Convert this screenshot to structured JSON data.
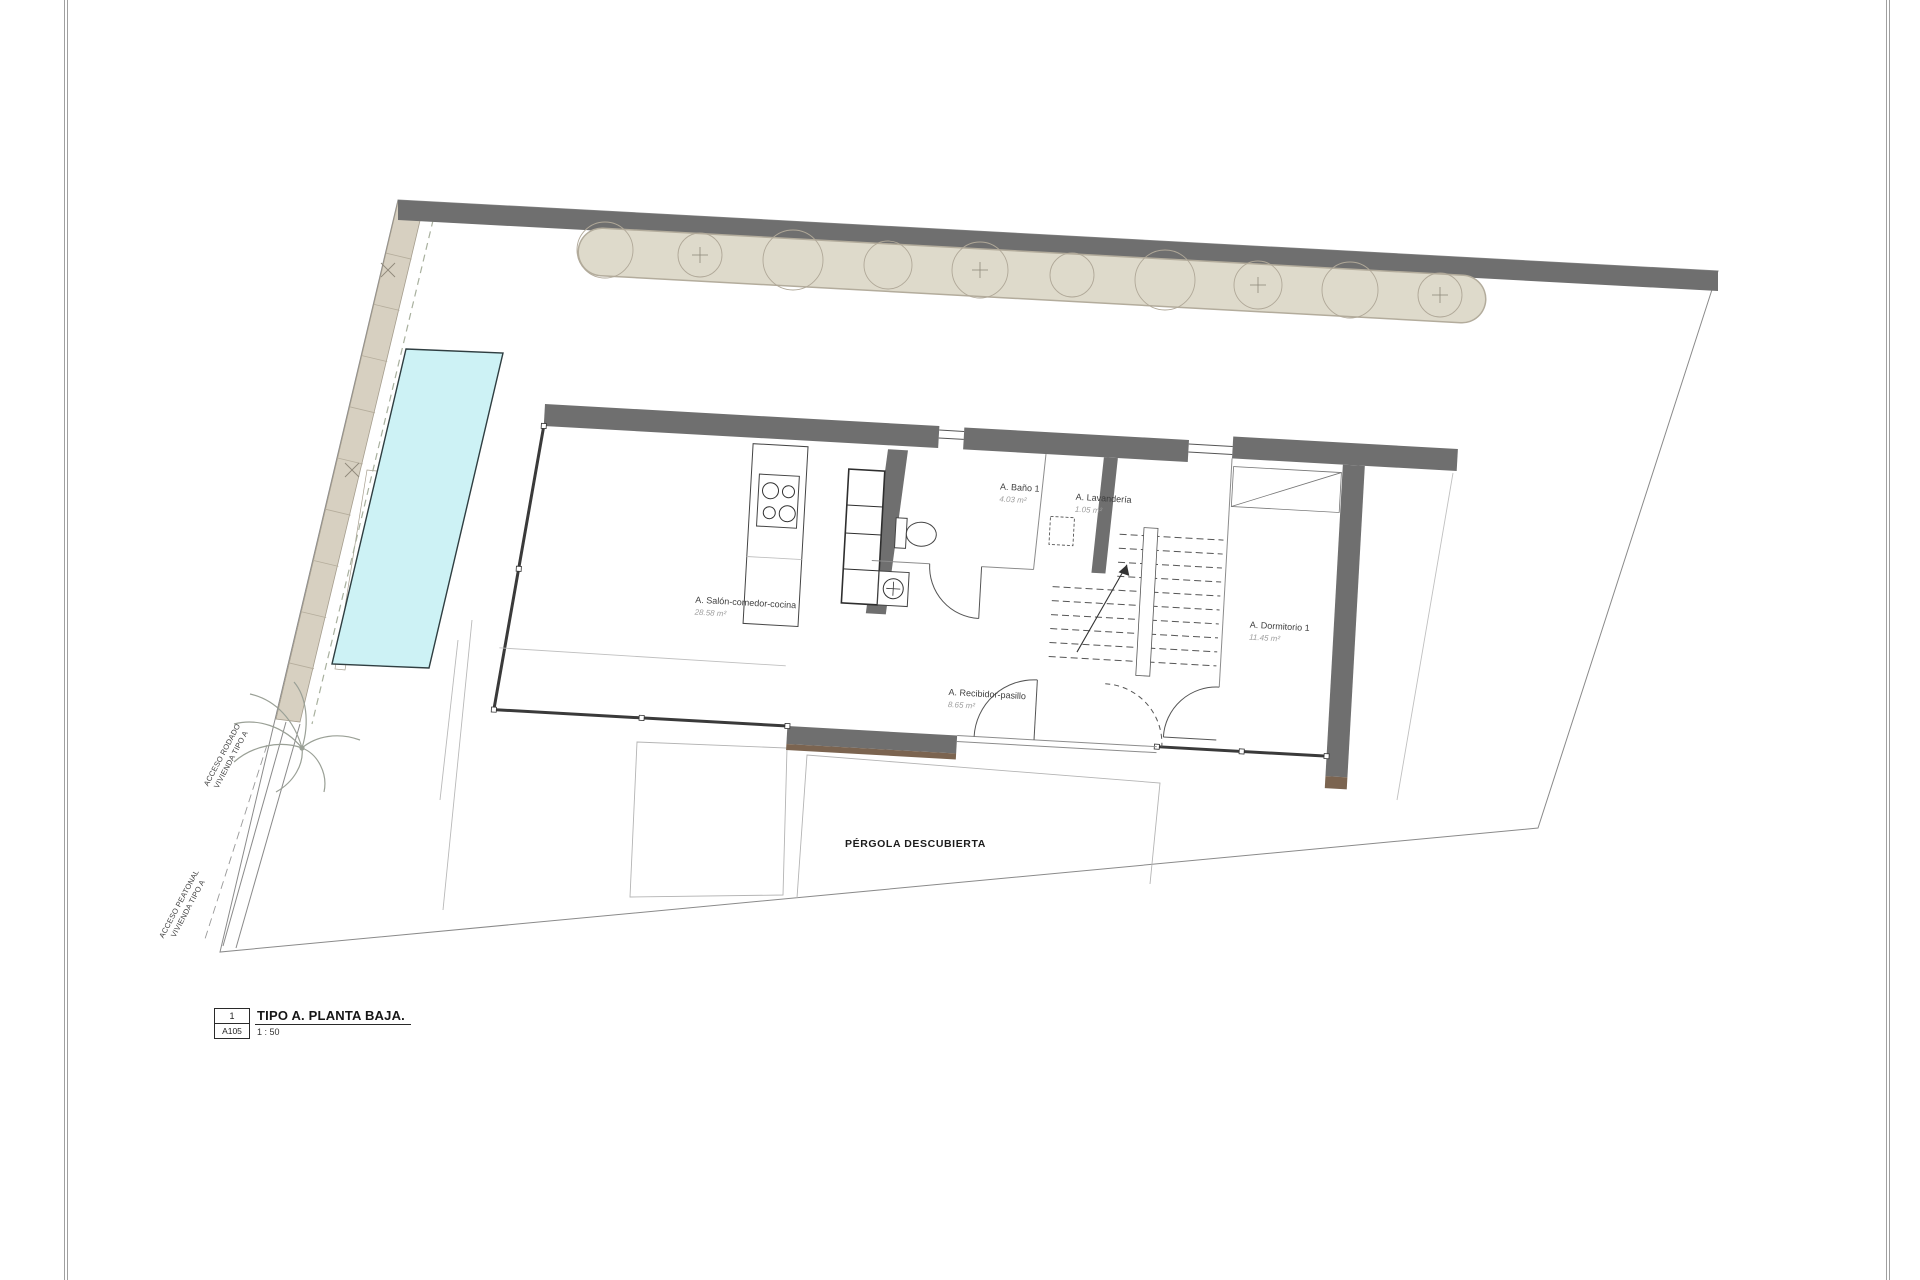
{
  "sheet": {
    "number": "1",
    "code": "A105",
    "title": "TIPO A. PLANTA BAJA.",
    "scale": "1 : 50"
  },
  "site": {
    "pergola_label": "PÉRGOLA DESCUBIERTA",
    "access_road": [
      "ACCESO RODADO",
      "VIVIENDA TIPO A"
    ],
    "access_pedestrian": [
      "ACCESO PEATONAL",
      "VIVIENDA TIPO A"
    ]
  },
  "rooms": [
    {
      "id": "salon",
      "name": "A. Salón-comedor-cocina",
      "area": "28.58 m²"
    },
    {
      "id": "bano1",
      "name": "A. Baño 1",
      "area": "4.03 m²"
    },
    {
      "id": "lavanderia",
      "name": "A. Lavandería",
      "area": "1.05 m²"
    },
    {
      "id": "dormitorio1",
      "name": "A. Dormitorio 1",
      "area": "11.45 m²"
    },
    {
      "id": "recibidor",
      "name": "A. Recibidor-pasillo",
      "area": "8.65 m²"
    }
  ],
  "colors": {
    "wall": "#6f6f6f",
    "pool": "#cdf2f5",
    "hedge": "#dedacb",
    "driveway": "#d7d0c1",
    "wood": "#7b6450"
  }
}
